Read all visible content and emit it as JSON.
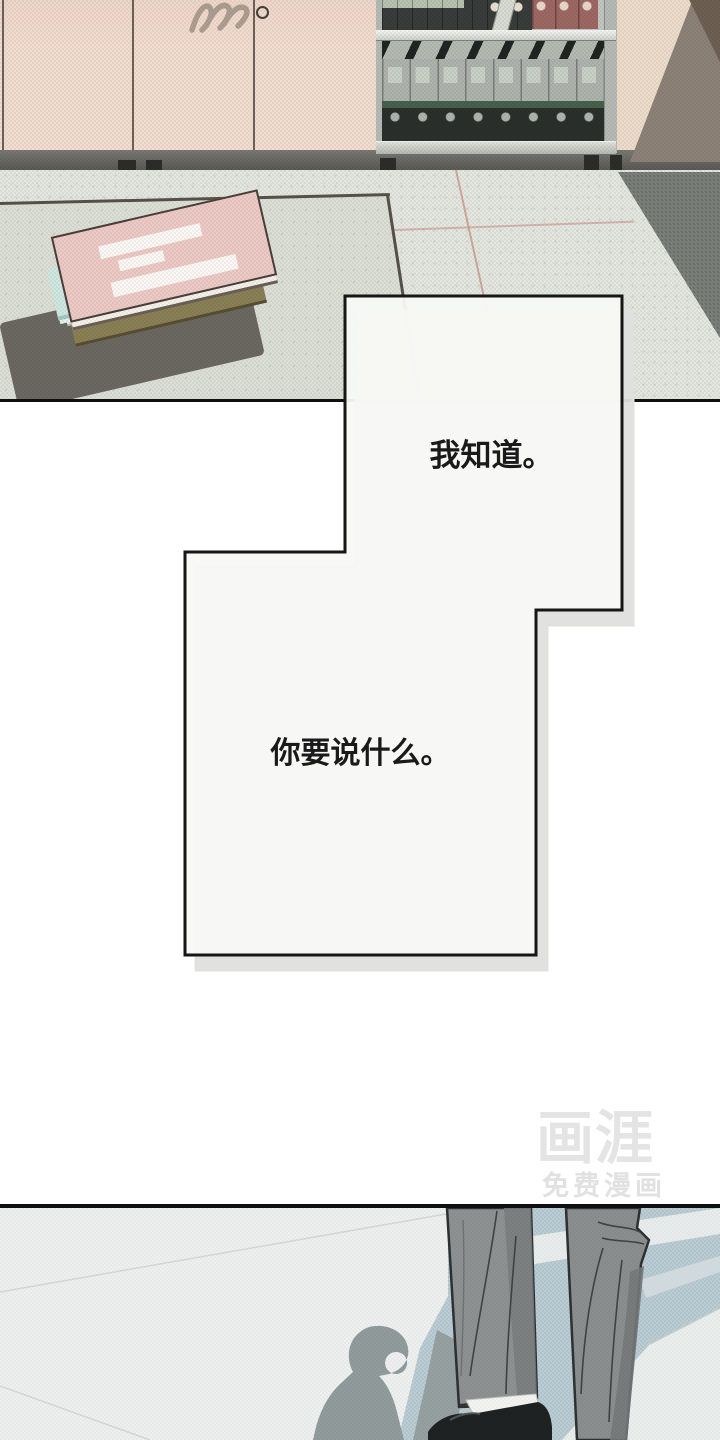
{
  "bubbles": {
    "top": {
      "text": "我知道。"
    },
    "bottom": {
      "text": "你要说什么。"
    }
  },
  "watermark": {
    "logo": "画涯",
    "tagline": "免费漫画"
  },
  "colors": {
    "cabinet": "#f2dcd0",
    "wall": "#eddcca",
    "wallShadow": "#8d8278",
    "baseboard": "#5f5e58",
    "floor": "#e4e7df",
    "floorShadow": "#7b817a",
    "table": "#dcdfd6",
    "binderRed": "#9d6763",
    "bookPink": "#edcac6",
    "bookMint": "#cfe7e1",
    "bookOlive": "#8a7f55",
    "bubbleFill": "#f8f9f6",
    "bubbleBorder": "#121212",
    "bubbleShadow": "#e0e1de",
    "text": "#1a1a1a",
    "floor2": "#edf0ef",
    "windowShadowBlue": "#c0d3d9",
    "personShadow": "#96a0a1",
    "pants": "#8e9192",
    "shoe": "#1f2222",
    "watermark": "#e4e4e4"
  }
}
